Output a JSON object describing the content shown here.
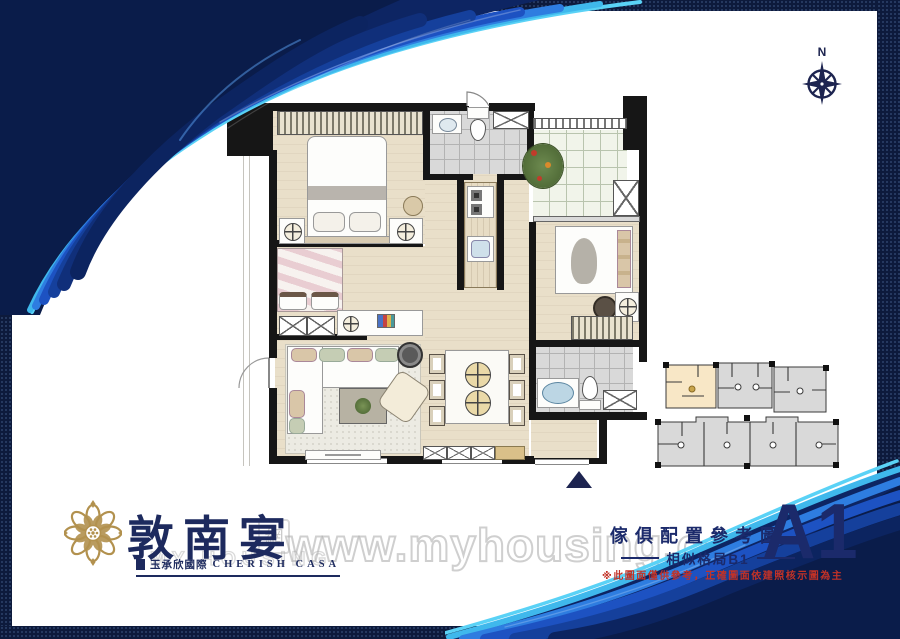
{
  "proof_stamp": {
    "text": "打樣稿"
  },
  "compass": {
    "label": "N"
  },
  "brand": {
    "name": "敦南宴",
    "developer": "玉承欣國際",
    "developer_en": "CHERISH CASA"
  },
  "caption": {
    "title": "傢俱配置參考圖",
    "similar_layout": "相似格局B1",
    "unit_code": "A1",
    "disclaimer": "※此圖面僅供參考，正確圖面依建照核示圖為主"
  },
  "watermark": {
    "url": "www.myhousing.com.tw",
    "ghost_text": "MY HOUSING",
    "ghost_cn": "網"
  },
  "colors": {
    "navy": "#1b2a6b",
    "gold": "#b2914e",
    "red": "#c13227",
    "wall": "#161616",
    "floor_beige": "#e9dfc9",
    "tile_gray": "#d9d9d9",
    "highlight_unit": "#f8e7c6",
    "wave_cyan": "#49c3f0",
    "wave_blue": "#1d4cc0",
    "wave_navy": "#0c2058"
  }
}
